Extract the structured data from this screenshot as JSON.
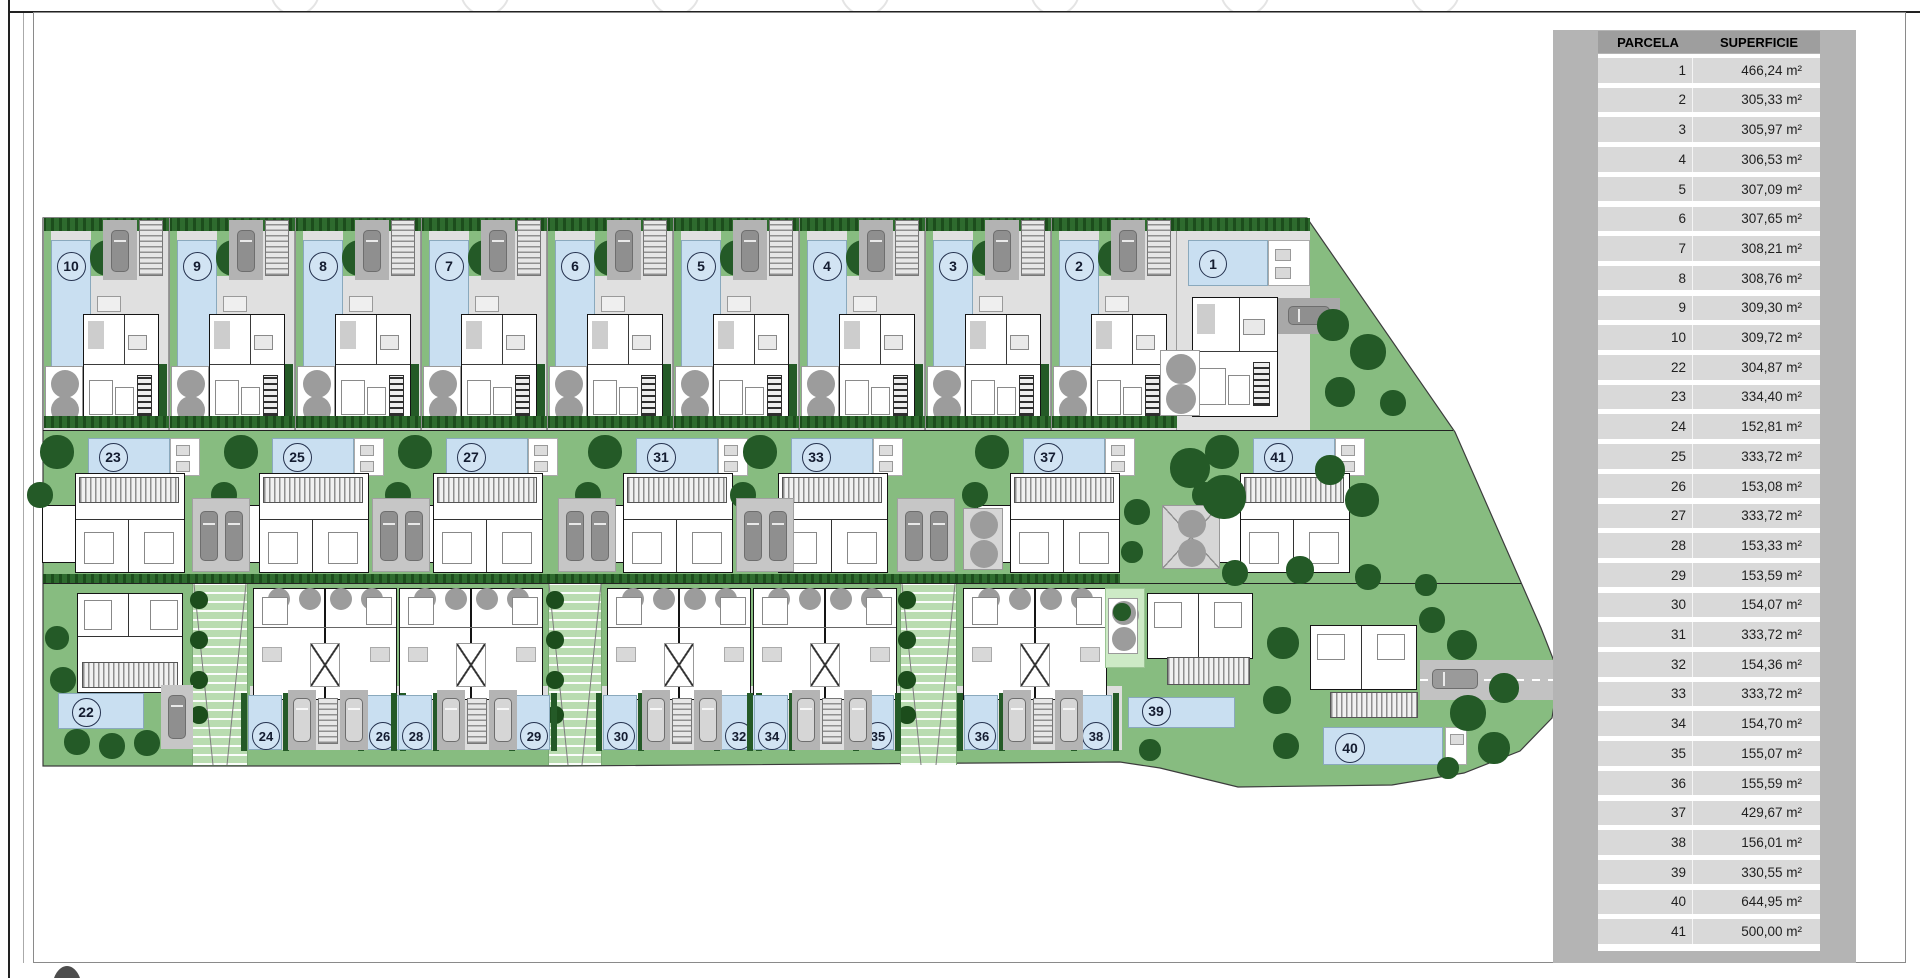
{
  "table": {
    "headers": [
      "PARCELA",
      "SUPERFICIE"
    ],
    "rows": [
      [
        "1",
        "466,24 m²"
      ],
      [
        "2",
        "305,33 m²"
      ],
      [
        "3",
        "305,97 m²"
      ],
      [
        "4",
        "306,53 m²"
      ],
      [
        "5",
        "307,09 m²"
      ],
      [
        "6",
        "307,65 m²"
      ],
      [
        "7",
        "308,21 m²"
      ],
      [
        "8",
        "308,76 m²"
      ],
      [
        "9",
        "309,30 m²"
      ],
      [
        "10",
        "309,72 m²"
      ],
      [
        "22",
        "304,87 m²"
      ],
      [
        "23",
        "334,40 m²"
      ],
      [
        "24",
        "152,81 m²"
      ],
      [
        "25",
        "333,72 m²"
      ],
      [
        "26",
        "153,08 m²"
      ],
      [
        "27",
        "333,72 m²"
      ],
      [
        "28",
        "153,33 m²"
      ],
      [
        "29",
        "153,59 m²"
      ],
      [
        "30",
        "154,07 m²"
      ],
      [
        "31",
        "333,72 m²"
      ],
      [
        "32",
        "154,36 m²"
      ],
      [
        "33",
        "333,72 m²"
      ],
      [
        "34",
        "154,70 m²"
      ],
      [
        "35",
        "155,07 m²"
      ],
      [
        "36",
        "155,59 m²"
      ],
      [
        "37",
        "429,67 m²"
      ],
      [
        "38",
        "156,01 m²"
      ],
      [
        "39",
        "330,55 m²"
      ],
      [
        "40",
        "644,95 m²"
      ],
      [
        "41",
        "500,00 m²"
      ]
    ]
  },
  "plan": {
    "top_villas": [
      {
        "label": "10",
        "x": 43
      },
      {
        "label": "9",
        "x": 169
      },
      {
        "label": "8",
        "x": 295
      },
      {
        "label": "7",
        "x": 421
      },
      {
        "label": "6",
        "x": 547
      },
      {
        "label": "5",
        "x": 673
      },
      {
        "label": "4",
        "x": 799
      },
      {
        "label": "3",
        "x": 925
      },
      {
        "label": "2",
        "x": 1051
      }
    ],
    "parcel_1": {
      "label": "1",
      "x": 1177
    },
    "mid_villas": [
      {
        "label": "23",
        "cx": 112
      },
      {
        "label": "25",
        "cx": 296
      },
      {
        "label": "27",
        "cx": 470
      },
      {
        "label": "31",
        "cx": 660
      },
      {
        "label": "33",
        "cx": 815
      },
      {
        "label": "37",
        "cx": 1047
      },
      {
        "label": "41",
        "cx": 1277
      }
    ],
    "mid_driveways": [
      192,
      372,
      558,
      736,
      897
    ],
    "townhouse_blocks": [
      253,
      399,
      607,
      753,
      963
    ],
    "walkways": [
      {
        "x": 192,
        "w": 56
      },
      {
        "x": 548,
        "w": 54
      },
      {
        "x": 900,
        "w": 57
      }
    ],
    "bottom_pools": [
      {
        "label": "24",
        "cx": 265
      },
      {
        "label": "26",
        "cx": 382
      },
      {
        "label": "28",
        "cx": 415
      },
      {
        "label": "29",
        "cx": 533
      },
      {
        "label": "30",
        "cx": 620
      },
      {
        "label": "32",
        "cx": 738
      },
      {
        "label": "34",
        "cx": 771
      },
      {
        "label": "35",
        "cx": 877
      },
      {
        "label": "36",
        "cx": 981
      },
      {
        "label": "38",
        "cx": 1095
      }
    ],
    "parking_groups": [
      288,
      437,
      642,
      792,
      1003
    ],
    "parcel_22": {
      "label": "22"
    },
    "parcel_39": {
      "label": "39"
    },
    "parcel_40": {
      "label": "40"
    },
    "trees": [
      {
        "x": 1333,
        "y": 325,
        "r": 16
      },
      {
        "x": 1368,
        "y": 352,
        "r": 18
      },
      {
        "x": 1340,
        "y": 392,
        "r": 15
      },
      {
        "x": 1393,
        "y": 403,
        "r": 13
      },
      {
        "x": 1190,
        "y": 468,
        "r": 20
      },
      {
        "x": 1224,
        "y": 497,
        "r": 22
      },
      {
        "x": 1330,
        "y": 470,
        "r": 15
      },
      {
        "x": 1362,
        "y": 500,
        "r": 17
      },
      {
        "x": 1137,
        "y": 512,
        "r": 13
      },
      {
        "x": 1132,
        "y": 552,
        "r": 11
      },
      {
        "x": 1235,
        "y": 573,
        "r": 13
      },
      {
        "x": 1300,
        "y": 570,
        "r": 14
      },
      {
        "x": 1368,
        "y": 577,
        "r": 13
      },
      {
        "x": 1426,
        "y": 585,
        "r": 11
      },
      {
        "x": 1283,
        "y": 643,
        "r": 16
      },
      {
        "x": 1277,
        "y": 700,
        "r": 14
      },
      {
        "x": 1286,
        "y": 746,
        "r": 13
      },
      {
        "x": 1468,
        "y": 713,
        "r": 18
      },
      {
        "x": 1504,
        "y": 688,
        "r": 15
      },
      {
        "x": 1494,
        "y": 748,
        "r": 16
      },
      {
        "x": 1448,
        "y": 768,
        "r": 11
      },
      {
        "x": 1432,
        "y": 620,
        "r": 13
      },
      {
        "x": 1462,
        "y": 645,
        "r": 15
      },
      {
        "x": 57,
        "y": 638,
        "r": 12
      },
      {
        "x": 63,
        "y": 680,
        "r": 13
      },
      {
        "x": 77,
        "y": 742,
        "r": 13
      },
      {
        "x": 112,
        "y": 746,
        "r": 13
      },
      {
        "x": 147,
        "y": 743,
        "r": 13
      },
      {
        "x": 1150,
        "y": 750,
        "r": 11
      },
      {
        "x": 1122,
        "y": 612,
        "r": 9
      }
    ]
  },
  "colors": {
    "site_green": "#87bc80",
    "tree_green": "#245a27",
    "pool_blue": "#c9dff1",
    "plot_gray": "#e0e0e0",
    "panel_gray": "#b4b4b4",
    "header_gray": "#9e9e9e",
    "row_gray": "#d9d9d9",
    "garage_gray": "#b3b3b3",
    "car_gray": "#8f8f8f",
    "gray_tree": "#9c9c9c"
  }
}
